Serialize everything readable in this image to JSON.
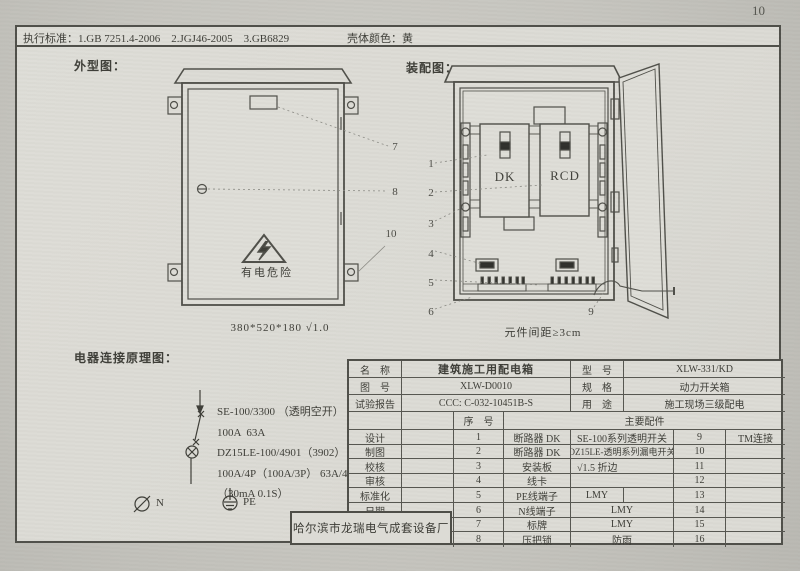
{
  "page_number": "10",
  "header": {
    "standards": "执行标准：1.GB 7251.4-2006    2.JGJ46-2005    3.GB6829",
    "shell_color": "壳体颜色：黄"
  },
  "outline": {
    "title": "外型图：",
    "warning_text": "有电危险",
    "dimension_caption": "380*520*180 √1.0",
    "callouts": {
      "c7": "7",
      "c8": "8",
      "c10": "10"
    }
  },
  "assembly": {
    "title": "装配图：",
    "dk_label": "DK",
    "rcd_label": "RCD",
    "spacing_caption": "元件间距≥3cm",
    "callouts": {
      "c1": "1",
      "c2": "2",
      "c3": "3",
      "c4": "4",
      "c5": "5",
      "c6": "6",
      "c9": "9"
    }
  },
  "schematic": {
    "title": "电器连接原理图：",
    "lines": [
      "SE-100/3300 （透明空开）",
      "100A  63A",
      "DZ15LE-100/4901（3902） （透明漏电开关）",
      "100A/4P（100A/3P） 63A/4P（63A/3P）",
      "（30mA 0.1S）"
    ],
    "n_label": "N",
    "pe_label": "PE"
  },
  "title_block": {
    "name_label": "名　称",
    "name_value": "建筑施工用配电箱",
    "model_label": "型　号",
    "model_value": "XLW-331/KD",
    "drawing_label": "图　号",
    "drawing_value": "XLW-D0010",
    "spec_label": "规　格",
    "spec_value": "动力开关箱",
    "report_label": "试验报告",
    "report_value": "CCC: C-032-10451B-S",
    "use_label": "用　途",
    "use_value": "施工现场三级配电",
    "seq_label": "序　号",
    "parts_label": "主要配件",
    "sign_rows": [
      "设计",
      "制图",
      "校核",
      "审核",
      "标准化",
      "日期"
    ],
    "parts": [
      {
        "no": "1",
        "name": "断路器 DK",
        "spec": "SE-100系列透明开关",
        "no2": "9",
        "extra": "TM连接"
      },
      {
        "no": "2",
        "name": "断路器 DK",
        "spec": "DZ15LE-透明系列漏电开关",
        "no2": "10",
        "extra": ""
      },
      {
        "no": "3",
        "name": "安装板",
        "spec": "√1.5 折边",
        "no2": "11",
        "extra": ""
      },
      {
        "no": "4",
        "name": "线卡",
        "spec": "",
        "no2": "12",
        "extra": ""
      },
      {
        "no": "5",
        "name": "PE线端子",
        "spec": "LMY",
        "no2": "13",
        "extra": ""
      },
      {
        "no": "6",
        "name": "N线端子",
        "spec": "LMY",
        "no2": "14",
        "extra": ""
      },
      {
        "no": "7",
        "name": "标牌",
        "spec": "LMY",
        "no2": "15",
        "extra": ""
      },
      {
        "no": "8",
        "name": "压把锁",
        "spec": "防雨",
        "no2": "16",
        "extra": ""
      }
    ],
    "company": "哈尔滨市龙瑞电气成套设备厂"
  },
  "colors": {
    "paper": "#dbdad4",
    "background": "#c6c5bf",
    "line": "#4e4e48"
  }
}
